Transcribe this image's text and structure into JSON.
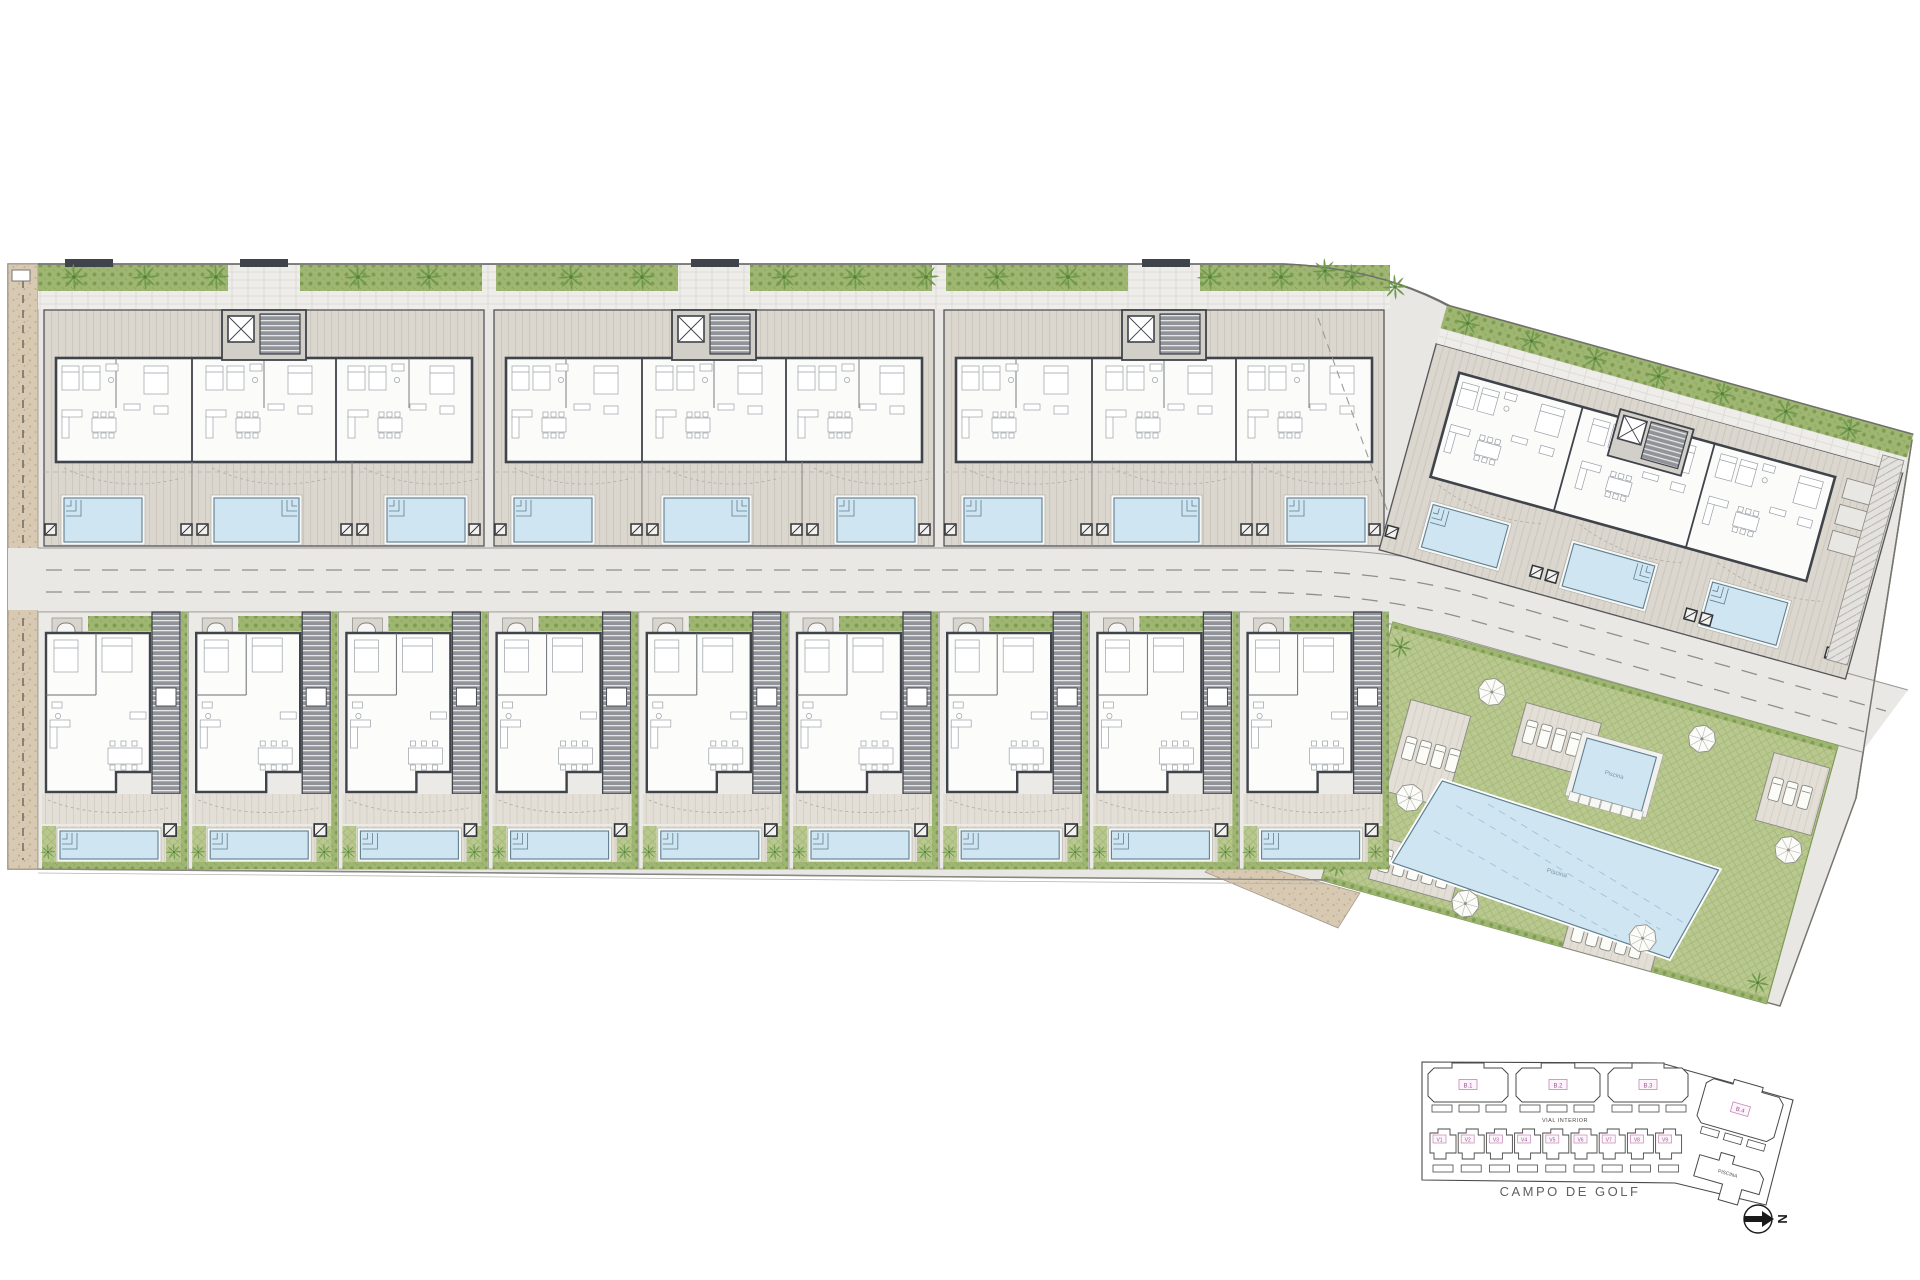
{
  "page": {
    "background": "#ffffff"
  },
  "site": {
    "blocks": [
      {
        "id": "B.1"
      },
      {
        "id": "B.2"
      },
      {
        "id": "B.3"
      },
      {
        "id": "B.4"
      }
    ],
    "villas": [
      {
        "id": "V1"
      },
      {
        "id": "V2"
      },
      {
        "id": "V3"
      },
      {
        "id": "V4"
      },
      {
        "id": "V5"
      },
      {
        "id": "V6"
      },
      {
        "id": "V7"
      },
      {
        "id": "V8"
      },
      {
        "id": "V9"
      }
    ],
    "communal": {
      "main_pool_label": "Piscina",
      "kids_pool_label": "Piscina"
    }
  },
  "key_plan": {
    "block_labels": [
      "B.1",
      "B.2",
      "B.3"
    ],
    "wing_block_label": "B.4",
    "villa_labels": [
      "V1",
      "V2",
      "V3",
      "V4",
      "V5",
      "V6",
      "V7",
      "V8",
      "V9"
    ],
    "road_label": "VIAL INTERIOR",
    "golf_label": "CAMPO DE GOLF",
    "pool_label": "PISCINA",
    "north_letter": "N"
  },
  "colors": {
    "grass": "#b9c88f",
    "grass_line": "#a6b87a",
    "hedge": "#9fb673",
    "hedge_dot": "#7f9d52",
    "palm": "#6f9a4e",
    "pool_water": "#cfe5f2",
    "pool_edge": "#5f7f8f",
    "wall": "#3f434a",
    "pad_stripe": "#dbd7cf",
    "road": "#eae8e5",
    "tan": "#d8c9b2",
    "label_pink": "#9c5490",
    "label_pink_border": "#c487b6",
    "keyline": "#4a4a48"
  }
}
